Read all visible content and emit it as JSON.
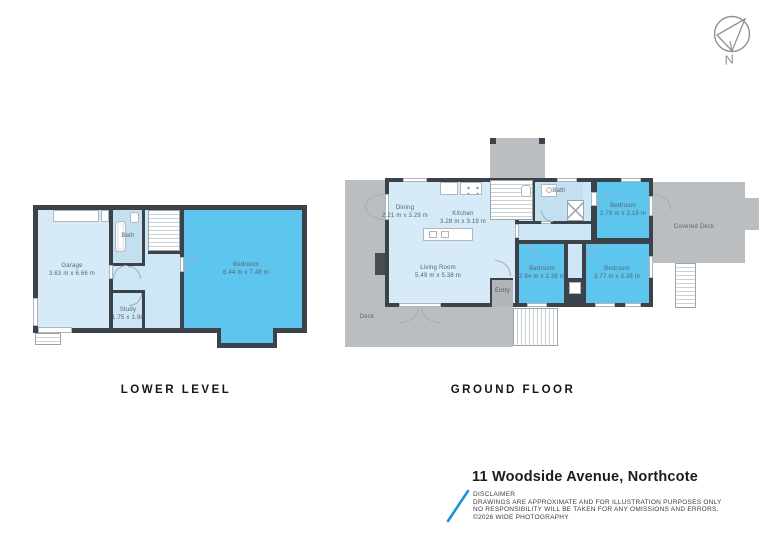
{
  "compass": {
    "label": "N"
  },
  "floors": {
    "lower": {
      "label": "LOWER LEVEL",
      "rooms": {
        "garage": {
          "name": "Garage",
          "dims": "3.63 m x 6.66 m"
        },
        "bath": {
          "name": "Bath"
        },
        "study": {
          "name": "Study",
          "dims": "1.75 x 1.98"
        },
        "bedroom": {
          "name": "Bedroom",
          "dims": "6.44 m x 7.48 m"
        }
      }
    },
    "ground": {
      "label": "GROUND FLOOR",
      "rooms": {
        "dining": {
          "name": "Dining",
          "dims": "2.21 m x 3.29 m"
        },
        "kitchen": {
          "name": "Kitchen",
          "dims": "3.28 m x 3.19 m"
        },
        "living": {
          "name": "Living Room",
          "dims": "5.49 m x 5.38 m"
        },
        "bath": {
          "name": "Bath"
        },
        "bedroom_top": {
          "name": "Bedroom",
          "dims": "2.79 m x 3.19 m"
        },
        "bedroom_mid": {
          "name": "Bedroom",
          "dims": "2.94 m x 3.38 m"
        },
        "bedroom_right": {
          "name": "Bedroom",
          "dims": "3.77 m x 3.38 m"
        },
        "entry": {
          "name": "Entry"
        },
        "deck": {
          "name": "Deck"
        },
        "covered_deck": {
          "name": "Covered Deck"
        }
      }
    }
  },
  "footer": {
    "address": "11 Woodside Avenue, Northcote",
    "disclaimer_title": "DISCLAIMER",
    "disclaimer_lines": [
      "DRAWINGS ARE APPROXIMATE AND FOR ILLUSTRATION PURPOSES ONLY",
      "NO RESPONSIBILITY WILL BE TAKEN FOR ANY OMISSIONS AND ERRORS.",
      "©2026 WIDE PHOTOGRAPHY"
    ]
  },
  "colors": {
    "wall": "#3b4249",
    "room_light": "#d6ebf7",
    "room_highlight": "#5ec6ee",
    "deck": "#babec1",
    "accent": "#1f92da"
  }
}
